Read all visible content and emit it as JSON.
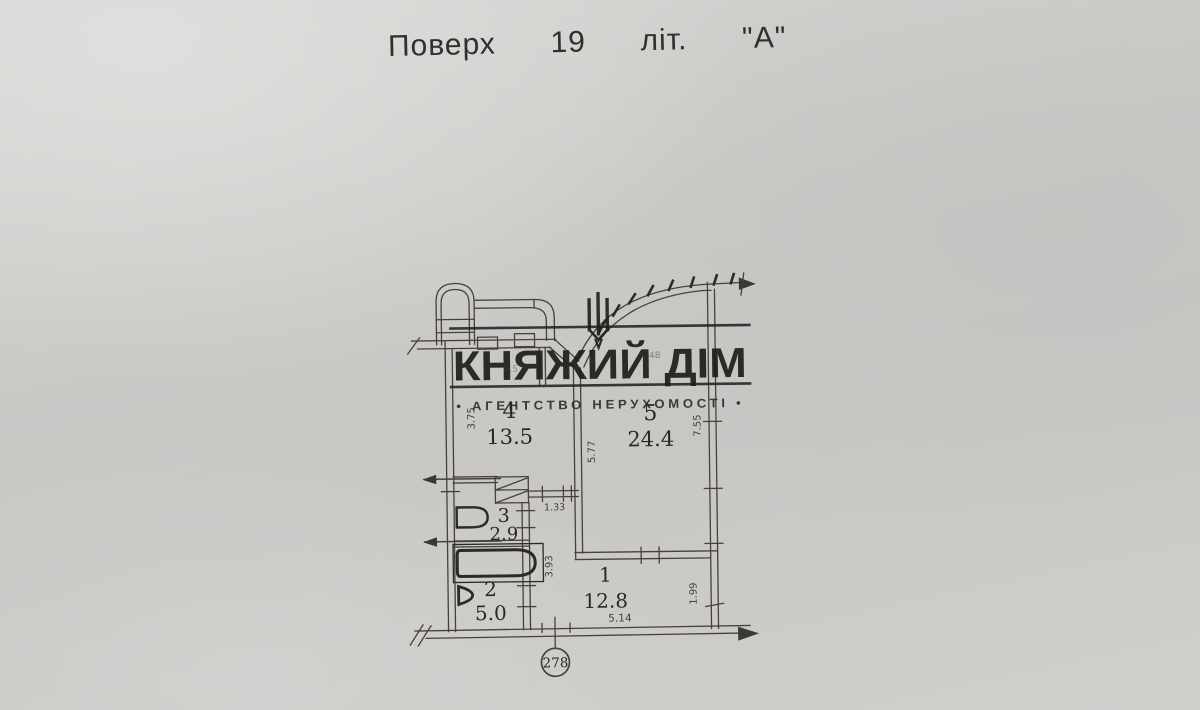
{
  "document": {
    "title": "Поверх  19  літ.  \"А\""
  },
  "watermark": {
    "brand": "КНЯЖИЙ ДІМ",
    "tagline": "• АГЕНТСТВО  НЕРУХОМОСТІ •"
  },
  "plan": {
    "rooms": [
      {
        "number": "1",
        "area": "12.8"
      },
      {
        "number": "2",
        "area": "5.0"
      },
      {
        "number": "3",
        "area": "2.9"
      },
      {
        "number": "4",
        "area": "13.5"
      },
      {
        "number": "5",
        "area": "24.4"
      }
    ],
    "dimensions": {
      "left_height": "3.75",
      "room5_left": "5.77",
      "right_upper": "7.55",
      "hall_width": "1.33",
      "bath_right": "3.93",
      "right_lower": "1.99",
      "bottom_width": "5.14",
      "balcony_left": "3.5",
      "balcony_right": "48"
    },
    "sheet_number": "278"
  },
  "colors": {
    "paper": "#cdcbc8",
    "line": "#45423e",
    "ink": "#1e1e1e"
  }
}
